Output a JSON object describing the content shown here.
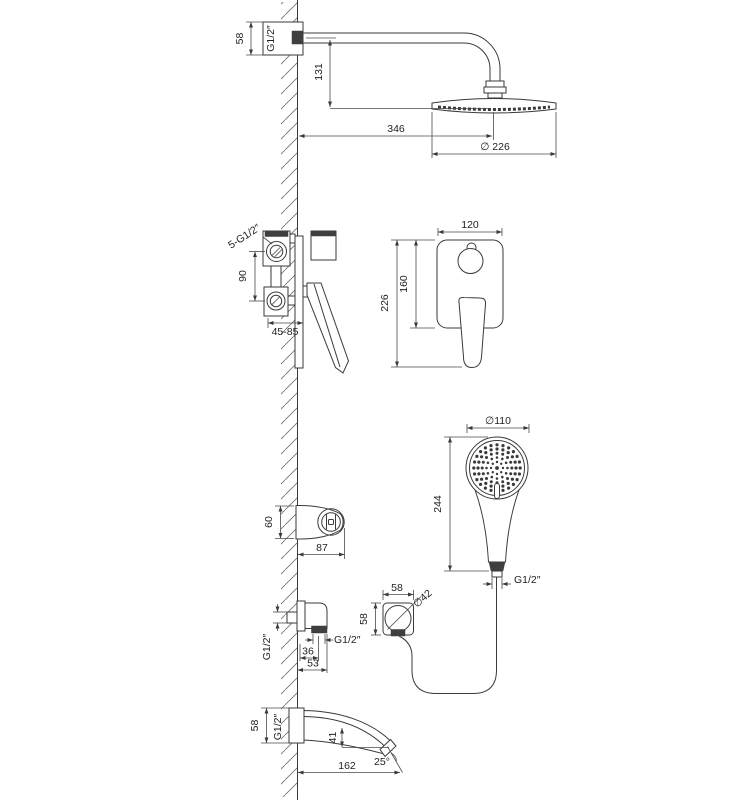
{
  "dims": {
    "rain": {
      "escutcheon_height": "58",
      "thread": "G1/2″",
      "head_drop": "131",
      "arm_reach": "346",
      "head_diameter": "∅ 226"
    },
    "mixer": {
      "connections": "5-G1/2″",
      "port_spacing": "90",
      "install_depth": "45-85",
      "plate_width": "120",
      "plate_height": "160",
      "overall_height": "226"
    },
    "hand": {
      "head_diameter": "∅110",
      "length": "244",
      "hose_thread": "G1/2″"
    },
    "holder": {
      "height": "60",
      "reach": "87"
    },
    "outlet": {
      "wall_thread": "G1/2″",
      "hose_thread": "G1/2″",
      "connector_offset": "36",
      "depth": "53",
      "face_width": "58",
      "face_height": "58",
      "face_circle": "∅42"
    },
    "spout": {
      "escutcheon_height": "58",
      "thread": "G1/2″",
      "tip_drop": "41",
      "length": "162",
      "tip_angle": "25°"
    }
  }
}
